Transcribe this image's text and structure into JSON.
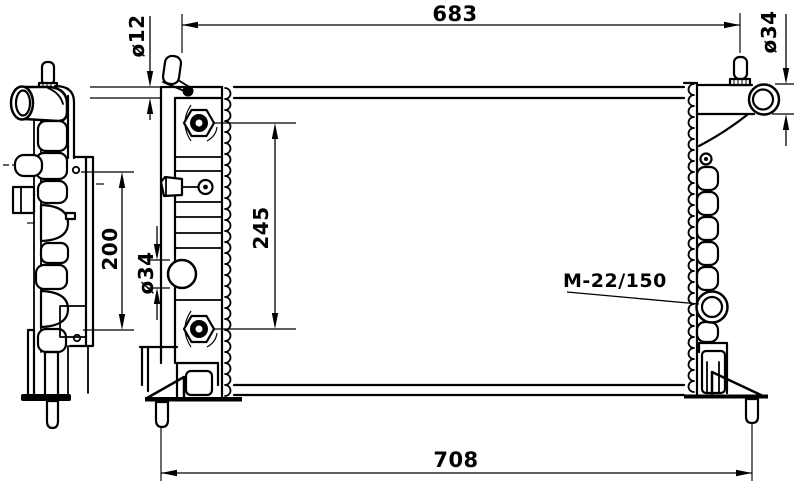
{
  "drawing": {
    "background": "#ffffff",
    "line_color": "#000000",
    "labels": {
      "top_width": "683",
      "bottom_width": "708",
      "port_spacing": "245",
      "side_mount_spacing": "200",
      "bleed_pin_diameter": "ø12",
      "left_outlet_diameter": "ø34",
      "right_inlet_diameter": "ø34",
      "drain_thread": "M-22/150"
    }
  }
}
